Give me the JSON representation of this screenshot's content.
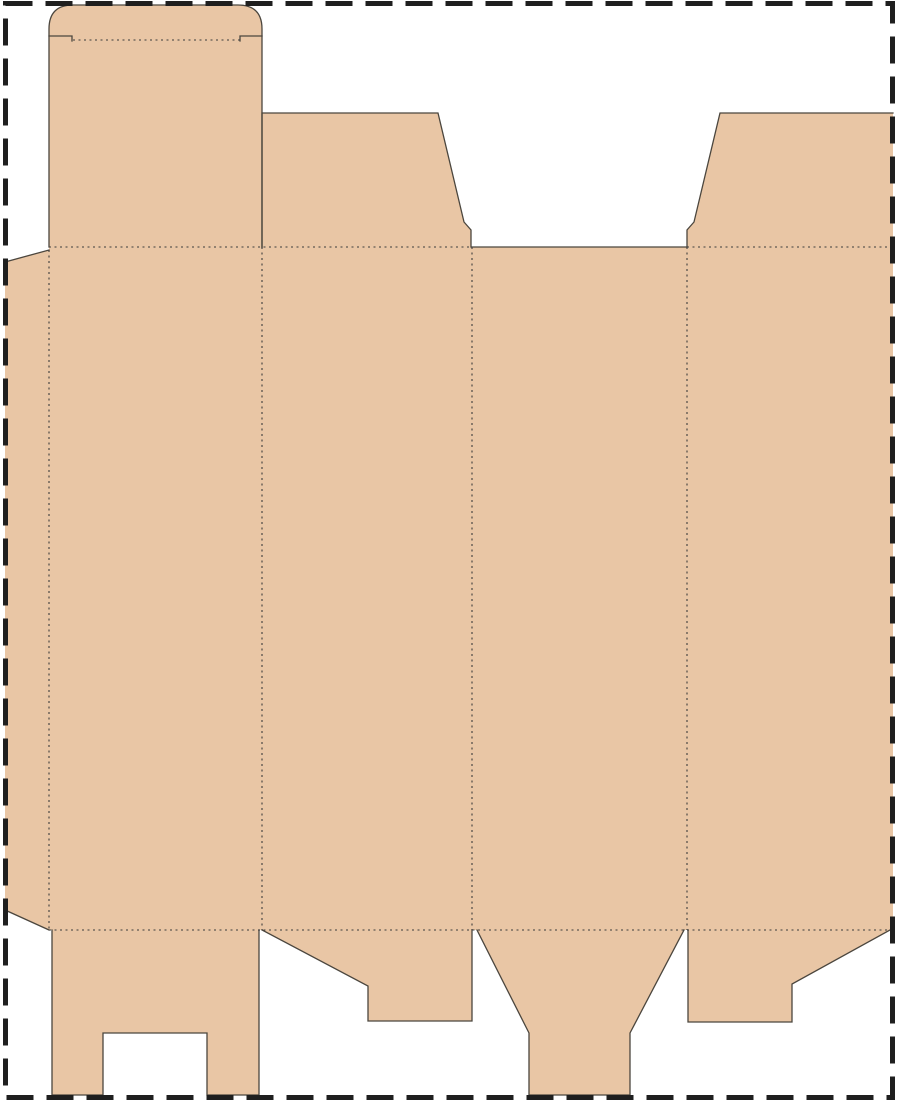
{
  "canvas": {
    "width": 900,
    "height": 1102,
    "background": "#ffffff"
  },
  "colors": {
    "board": "#e9c6a5",
    "cut": "#4b463e",
    "fold": "#3c3c3c",
    "frame": "#1f1f1f"
  },
  "frame_style": {
    "dash": "27 13",
    "thickness": 5
  },
  "fold_style": {
    "dash": "2 3.5",
    "thickness": 1.1
  },
  "cut_style": {
    "thickness": 1.3
  },
  "parts": {
    "glue_flap": "glue-flap",
    "main_panels": "main-panels",
    "tuck_lid": "tuck-lid-flap",
    "top_dust_flap_left": "top-dust-flap-left",
    "top_dust_flap_right": "top-dust-flap-right",
    "bottom_flap_legs": "bottom-flap-with-notch",
    "bottom_lock_flap_left": "bottom-lock-flap-left",
    "bottom_tongue_flap": "bottom-tongue-flap",
    "bottom_lock_flap_right": "bottom-lock-flap-right"
  }
}
